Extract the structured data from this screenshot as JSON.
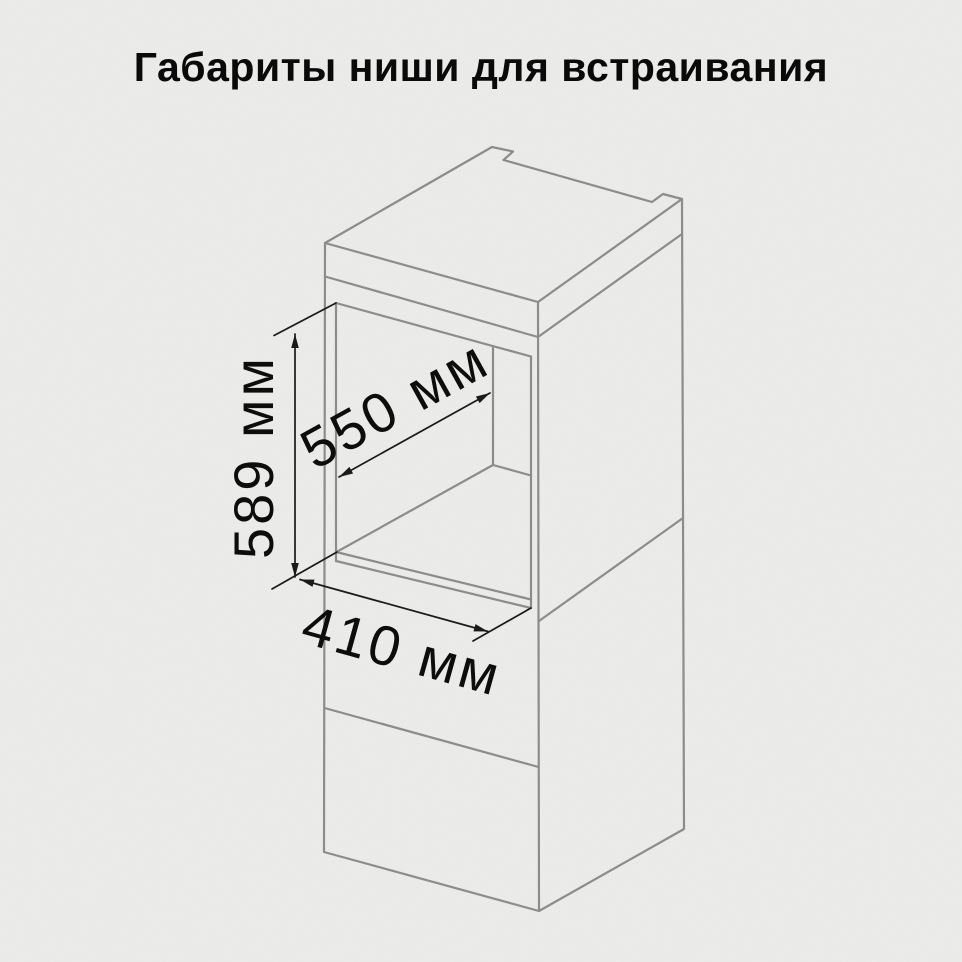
{
  "title": "Габариты ниши для встраивания",
  "dimensions": {
    "height": "589 мм",
    "depth": "550 мм",
    "width": "410 мм"
  },
  "colors": {
    "background": "#ececea",
    "cabinet_line": "#8c8c8c",
    "dimension_line": "#1a1a1a",
    "text": "#0d0d0d",
    "title": "#0a0a0a"
  }
}
